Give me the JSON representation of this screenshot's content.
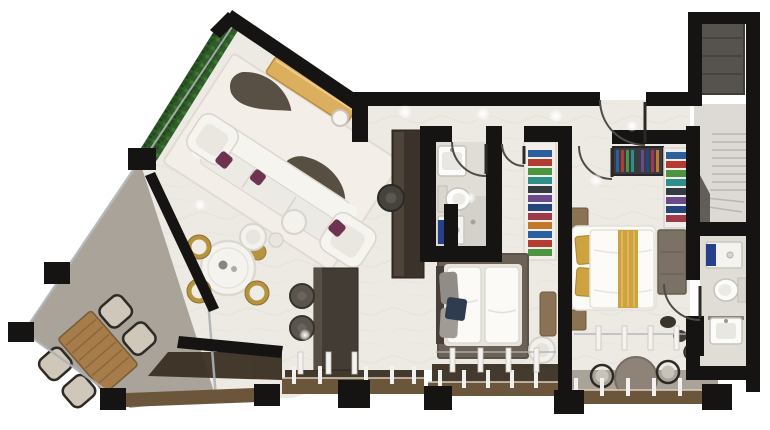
{
  "scene": {
    "type": "3d-floor-plan-render",
    "description": "Top-down 3D architectural rendering of an angular apartment: living/dining wing with wrap-around terrace at left, kitchen, hallway, two bedrooms, two bathrooms, walk-in closets, staircase and entry vestibule at right, rear balcony at bottom right"
  },
  "colors": {
    "background": "#ffffff",
    "wall": "#151413",
    "floor": "#edeae4",
    "floor_balcony": "#a9a39a",
    "floor_bath": "#e0ddd7",
    "floor_stairs": "#dddad5",
    "entry_mat": "#56534e",
    "hedge_green": "#2f5c28",
    "rug_living": "#f3efe8",
    "rug_pattern": "#4b4236",
    "rug_bedroom": "#6b6156",
    "sofa_white": "#f6f4ef",
    "accent_plum": "#6e3350",
    "gold_console": "#dcaf5e",
    "gold_chair": "#b5933f",
    "gold_textile": "#cda23f",
    "wood_table": "#a57c4a",
    "wood_furniture": "#8a7354",
    "kitchen_dark": "#433c34",
    "bed_white": "#fbfaf7",
    "pillow_grey": "#918c85",
    "throw_navy": "#2f3c50",
    "white_fixture": "#fbfbf9",
    "washer_blue": "#27408b",
    "railing_bronze": "#6b563c",
    "deck_dark": "#3a2f23",
    "glass": "#aeb2b6",
    "door_arc": "#4f4c48",
    "shaft_dark": "#57534d"
  },
  "closets": {
    "palette": [
      "#2b5f9e",
      "#b23c32",
      "#4c9440",
      "#2e8f8a",
      "#333a40",
      "#6b4a8c",
      "#23467f",
      "#9e3a4a",
      "#c2782a"
    ]
  },
  "rooms": [
    {
      "id": "living-room",
      "furniture": [
        "area-rug",
        "l-shaped-sofa",
        "armchair",
        "armchair",
        "accent-pillows",
        "coffee-tables",
        "console-table",
        "floor-lamp",
        "hedge-planter"
      ]
    },
    {
      "id": "dining-area",
      "furniture": [
        "round-table",
        "gold-chairs",
        "white-armchair"
      ]
    },
    {
      "id": "terrace",
      "furniture": [
        "wood-table",
        "outdoor-chairs"
      ]
    },
    {
      "id": "kitchen",
      "furniture": [
        "island",
        "bar-stools",
        "tall-units",
        "planter"
      ]
    },
    {
      "id": "hallway",
      "furniture": []
    },
    {
      "id": "bathroom",
      "furniture": [
        "sink",
        "toilet",
        "washer",
        "shower"
      ]
    },
    {
      "id": "inner-bedroom",
      "furniture": [
        "double-bed",
        "rug",
        "pillows",
        "chair",
        "bench",
        "closet-shelves"
      ]
    },
    {
      "id": "master-bedroom",
      "furniture": [
        "double-bed",
        "gold-runner",
        "nightstands",
        "dresser",
        "wardrobe",
        "clothes-rail"
      ]
    },
    {
      "id": "master-bathroom",
      "furniture": [
        "toilet",
        "sink",
        "washer"
      ]
    },
    {
      "id": "staircase",
      "furniture": [
        "steps"
      ]
    },
    {
      "id": "entry-vestibule",
      "furniture": [
        "door-mat"
      ]
    },
    {
      "id": "rear-balcony",
      "furniture": [
        "round-table",
        "wire-chairs",
        "pot"
      ]
    }
  ]
}
